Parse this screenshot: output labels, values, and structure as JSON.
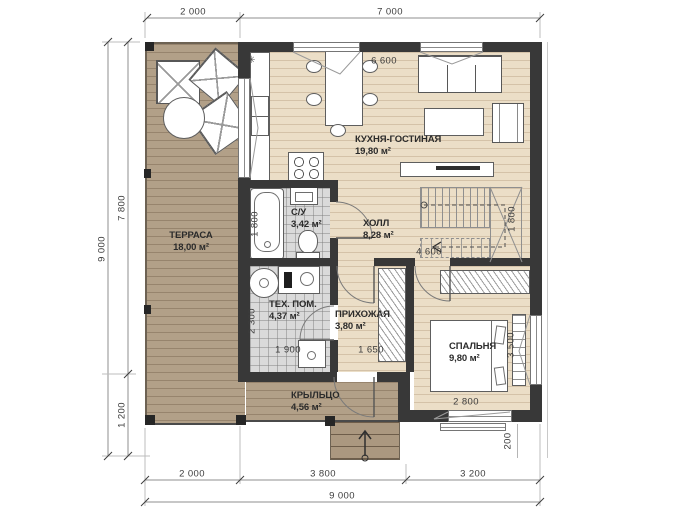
{
  "plan": {
    "rooms": {
      "terrace": {
        "name": "ТЕРРАСА",
        "area": "18,00 м²"
      },
      "kitchen_living": {
        "name": "КУХНЯ-ГОСТИНАЯ",
        "area": "19,80 м²"
      },
      "bathroom": {
        "name": "С/У",
        "area": "3,42 м²"
      },
      "hall": {
        "name": "ХОЛЛ",
        "area": "8,28 м²"
      },
      "tech_room": {
        "name": "ТЕХ. ПОМ.",
        "area": "4,37 м²"
      },
      "hallway": {
        "name": "ПРИХОЖАЯ",
        "area": "3,80 м²"
      },
      "bedroom": {
        "name": "СПАЛЬНЯ",
        "area": "9,80 м²"
      },
      "porch": {
        "name": "КРЫЛЬЦО",
        "area": "4,56 м²"
      }
    },
    "dimensions": {
      "top_terrace": "2 000",
      "top_house": "7 000",
      "left_total": "9 000",
      "left_house": "7 800",
      "left_porch": "1 200",
      "bottom_terrace": "2 000",
      "bottom_center": "3 800",
      "bottom_right": "3 200",
      "bottom_total": "9 000",
      "kitchen_width": "6 600",
      "bath_tub": "1 800",
      "stairs_width": "1 800",
      "hall_width": "4 600",
      "tech_depth": "2 300",
      "tech_width": "1 900",
      "hallway_width": "1 650",
      "bedroom_depth": "3 500",
      "bedroom_width": "2 800",
      "wall_offset": "200"
    },
    "symbols": {
      "kitchen_lamp": "✳"
    },
    "colors": {
      "wall": "#383838",
      "deck": "#b2a088",
      "wood": "#ebdec7",
      "tile": "#dadada"
    }
  }
}
